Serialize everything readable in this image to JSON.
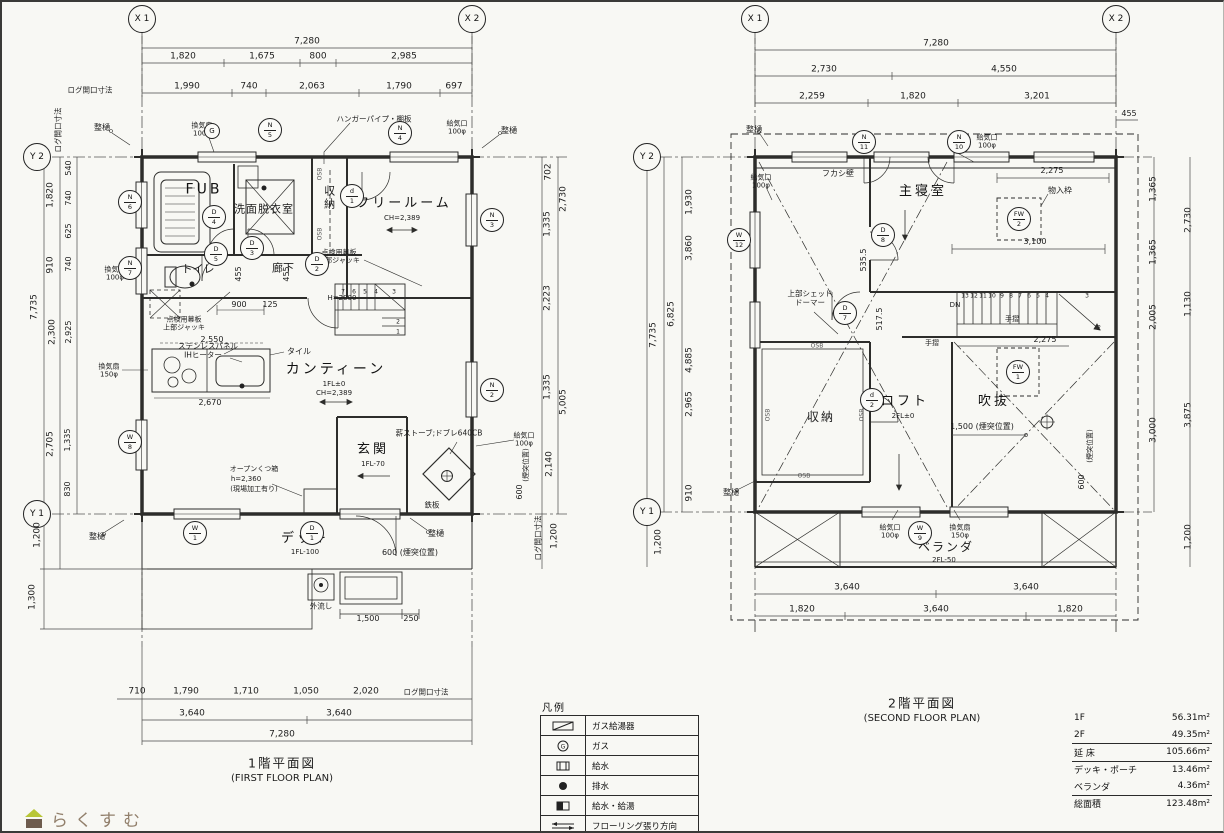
{
  "logo": {
    "text": "らくすむ"
  },
  "legend": {
    "title": "凡例",
    "rows": [
      {
        "icon": "gas-water-heater-icon",
        "label": "ガス給湯器"
      },
      {
        "icon": "gas-icon",
        "label": "ガス",
        "glyph": "G"
      },
      {
        "icon": "water-supply-icon",
        "label": "給水"
      },
      {
        "icon": "drain-icon",
        "label": "排水"
      },
      {
        "icon": "water-hot-supply-icon",
        "label": "給水・給湯"
      },
      {
        "icon": "flooring-direction-icon",
        "label": "フローリング張り方向"
      }
    ]
  },
  "area_table": {
    "rows": [
      {
        "label": "1F",
        "value": "56.31m²"
      },
      {
        "label": "2F",
        "value": "49.35m²"
      },
      {
        "label": "延 床",
        "value": "105.66m²"
      },
      {
        "label": "デッキ・ポーチ",
        "value": "13.46m²"
      },
      {
        "label": "ベランダ",
        "value": "4.36m²"
      },
      {
        "label": "総面積",
        "value": "123.48m²"
      }
    ]
  },
  "plan1": {
    "title": "1階平面図",
    "subtitle": "(FIRST FLOOR PLAN)",
    "grid": {
      "x1": "X 1",
      "x2": "X 2",
      "y2": "Y 2",
      "y1": "Y 1"
    },
    "rooms": {
      "fub": "FUB",
      "washroom": "洗面脱衣室",
      "closet": "収納",
      "freeroom": "フリールーム",
      "freeroom_ch": "CH=2,389",
      "toilet": "トイレ",
      "hall": "廊下",
      "canteen": "カンティーン",
      "canteen_fl": "1FL±0",
      "canteen_ch": "CH=2,389",
      "entrance": "玄関",
      "entrance_fl": "1FL-70",
      "deck": "デッキ",
      "deck_fl": "1FL-100"
    },
    "dims": {
      "top_total": "7,280",
      "top2": [
        "1,820",
        "1,675",
        "800",
        "2,985"
      ],
      "top3": [
        "1,990",
        "740",
        "2,063",
        "1,790",
        "697"
      ],
      "log_top": "ログ開口寸法",
      "log_left": "ログ開口寸法",
      "log_right": "ログ開口寸法",
      "log_bottom": "ログ開口寸法",
      "left_col1": [
        "7,735",
        "1,200",
        "1,300"
      ],
      "left_col2": [
        "1,820",
        "910",
        "2,300",
        "2,705"
      ],
      "left_col3": [
        "540",
        "740",
        "625",
        "740",
        "2,925",
        "1,335",
        "830"
      ],
      "right_inner": [
        "702",
        "1,335",
        "2,223",
        "1,335",
        "2,140"
      ],
      "right_outer": [
        "2,730",
        "5,005"
      ],
      "right_1200": "1,200",
      "chimney_v": "(煙突位置)",
      "chimney_600": "600",
      "chimney_h": "600 (煙突位置)",
      "bottom1": [
        "710",
        "1,790",
        "1,710",
        "1,050",
        "2,020"
      ],
      "bottom2": [
        "3,640",
        "3,640"
      ],
      "bottom3": "7,280",
      "k2550": "2,550",
      "k2670": "2,670",
      "d900": "900",
      "d125": "125",
      "h2000": "H=2000",
      "d455a": "455",
      "d455b": "455",
      "d1500": "1,500",
      "d250": "250"
    },
    "notes": {
      "toi_tl": "整樋",
      "toi_tr": "整樋",
      "toi_bl": "整樋",
      "toi_br": "整樋",
      "kanki_fub": [
        "換気扇",
        "100φ"
      ],
      "kanki_wc": [
        "換気扇",
        "100φ"
      ],
      "kanki_kit": [
        "換気扇",
        "150φ"
      ],
      "kyuki_tr": [
        "給気口",
        "100φ"
      ],
      "kyuki_stove": [
        "給気口",
        "100φ"
      ],
      "hanger": "ハンガーパイプ・棚板",
      "tenken1": [
        "点検用幕板",
        "上部ジャッキ"
      ],
      "tenken2": [
        "点検用幕板",
        "上部ジャッキ"
      ],
      "stainless": "ステンレスパネル",
      "ih": "IHヒーター",
      "tile": "タイル",
      "shoe": [
        "オープンくつ箱",
        "h=2,360",
        "(現場加工有り)"
      ],
      "stove": "薪ストーブ;ドブレ640CB",
      "teppan": "鉄板",
      "sink": "外流し",
      "osb1": "OSB",
      "osb2": "OSB"
    },
    "marks": {
      "g": "G",
      "n5": {
        "t": "N",
        "b": "5"
      },
      "n4": {
        "t": "N",
        "b": "4"
      },
      "n6": {
        "t": "N",
        "b": "6"
      },
      "n7": {
        "t": "N",
        "b": "7"
      },
      "w8": {
        "t": "W",
        "b": "8"
      },
      "n3": {
        "t": "N",
        "b": "3"
      },
      "n2": {
        "t": "N",
        "b": "2"
      },
      "w1": {
        "t": "W",
        "b": "1"
      },
      "d1": {
        "t": "D",
        "b": "1"
      },
      "dd1": {
        "t": "d",
        "b": "1"
      },
      "d2": {
        "t": "D",
        "b": "2"
      },
      "d3": {
        "t": "D",
        "b": "3"
      },
      "d4": {
        "t": "D",
        "b": "4"
      },
      "d5": {
        "t": "D",
        "b": "5"
      }
    },
    "stairs": [
      "7",
      "6",
      "5",
      "4",
      "3",
      "2",
      "1"
    ]
  },
  "plan2": {
    "title": "2階平面図",
    "subtitle": "(SECOND FLOOR PLAN)",
    "grid": {
      "x1": "X 1",
      "x2": "X 2",
      "y2": "Y 2",
      "y1": "Y 1"
    },
    "rooms": {
      "bedroom": "主寝室",
      "closet": "収納",
      "loft": "ロフト",
      "loft_fl": "2FL±0",
      "void": "吹抜",
      "veranda": "ベランダ",
      "veranda_fl": "2FL-50"
    },
    "dims": {
      "top_total": "7,280",
      "top2": [
        "2,730",
        "4,550"
      ],
      "top3": [
        "2,259",
        "1,820",
        "3,201"
      ],
      "d455": "455",
      "left_col1": [
        "7,735",
        "1,200"
      ],
      "left_6825": "6,825",
      "left_inner": [
        "1,930",
        "3,860",
        "4,885",
        "2,965",
        "910"
      ],
      "right_inner": [
        "1,365",
        "1,365",
        "2,005",
        "3,000"
      ],
      "right_outer": [
        "2,730",
        "1,130",
        "3,875",
        "1,200"
      ],
      "bottom1": [
        "3,640",
        "3,640"
      ],
      "bottom2": [
        "1,820",
        "3,640",
        "1,820"
      ],
      "d2275a": "2,275",
      "d3100": "3,100",
      "d2275b": "2,275",
      "d535": "535.5",
      "d517": "517.5",
      "chimney_h": "1,500 (煙突位置)",
      "chimney_v": "(煙突位置)",
      "chimney_600": "600"
    },
    "notes": {
      "toi_tl": "整樋",
      "toi_bl": "整樋",
      "fukashi": "フカシ壁",
      "monoire": "物入枠",
      "shed": [
        "上部シェッド",
        "ドーマー"
      ],
      "tesuri1": "手摺",
      "tesuri2": "手摺",
      "kyuki_tl": [
        "給気口",
        "100φ"
      ],
      "kyuki_st": [
        "給気口",
        "100φ"
      ],
      "kyuki_bal": [
        "給気口",
        "100φ"
      ],
      "kanki_bal": [
        "換気扇",
        "150φ"
      ],
      "dn": "DN",
      "osb1": "OSB",
      "osb2": "OSB",
      "osb3": "OSB",
      "osb4": "OSB"
    },
    "marks": {
      "n11": {
        "t": "N",
        "b": "11"
      },
      "n10": {
        "t": "N",
        "b": "10"
      },
      "w12": {
        "t": "W",
        "b": "12"
      },
      "d8": {
        "t": "D",
        "b": "8"
      },
      "d7": {
        "t": "D",
        "b": "7"
      },
      "dd2": {
        "t": "d",
        "b": "2"
      },
      "fw2": {
        "t": "FW",
        "b": "2"
      },
      "fw1": {
        "t": "FW",
        "b": "1"
      },
      "w9": {
        "t": "W",
        "b": "9"
      }
    },
    "stairs": [
      "13",
      "12",
      "11",
      "10",
      "9",
      "8",
      "7",
      "6",
      "5",
      "4"
    ],
    "stairs_3": "3",
    "stairs_2": "2"
  }
}
